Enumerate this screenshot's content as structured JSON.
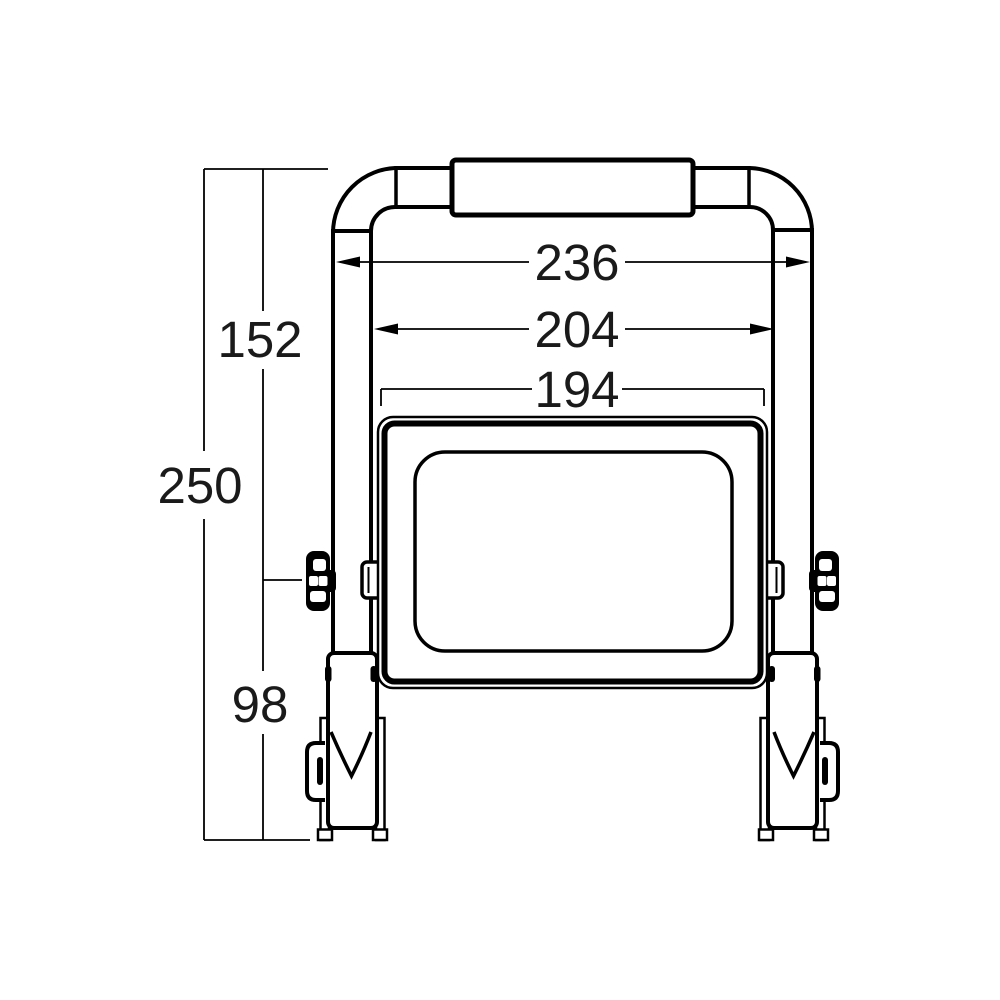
{
  "page": {
    "background": "#ffffff"
  },
  "drawing": {
    "description": "Front-view dimensional line drawing of an LED floodlight mounted on a folding carry-handle stand",
    "line_color": "#000000",
    "text_color": "#1a1a1a",
    "dimensions": {
      "overall_width": "236",
      "inner_frame_width": "204",
      "body_width": "194",
      "upper_height": "152",
      "overall_height": "250",
      "lower_height": "98"
    }
  }
}
